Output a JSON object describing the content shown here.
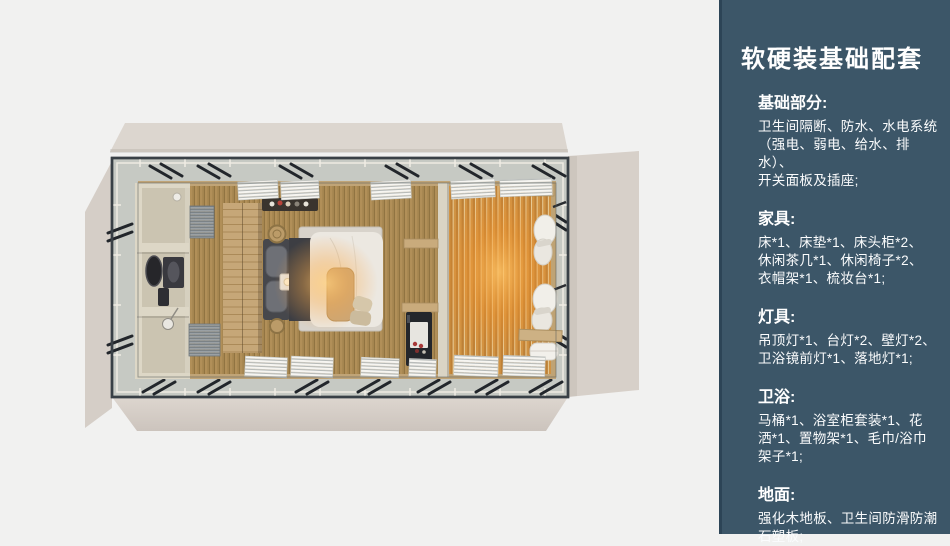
{
  "panel": {
    "background": "#3c5668",
    "title": "软硬装基础配套",
    "sections": [
      {
        "heading": "基础部分:",
        "body": "卫生间隔断、防水、水电系统\n（强电、弱电、给水、排水）、\n开关面板及插座;"
      },
      {
        "heading": "家具:",
        "body": "床*1、床垫*1、床头柜*2、\n休闲茶几*1、休闲椅子*2、\n衣帽架*1、梳妆台*1;"
      },
      {
        "heading": "灯具:",
        "body": "吊顶灯*1、台灯*2、壁灯*2、\n卫浴镜前灯*1、落地灯*1;"
      },
      {
        "heading": "卫浴:",
        "body": "马桶*1、浴室柜套装*1、花\n洒*1、置物架*1、毛巾/浴巾\n架子*1;"
      },
      {
        "heading": "地面:",
        "body": "强化木地板、卫生间防滑防潮\n石塑板;"
      }
    ]
  },
  "floor_plan": {
    "colors": {
      "background": "#f1f1f0",
      "tent_flap": "#d8d1c9",
      "deck_ring": "#c6c9c3",
      "frame": "#3a4047",
      "bedroom_wood": "#ad8c55",
      "lounge_glow": "#f2a64e",
      "bathroom": "#cbc4b1",
      "bedding": "#ece8e1"
    }
  }
}
